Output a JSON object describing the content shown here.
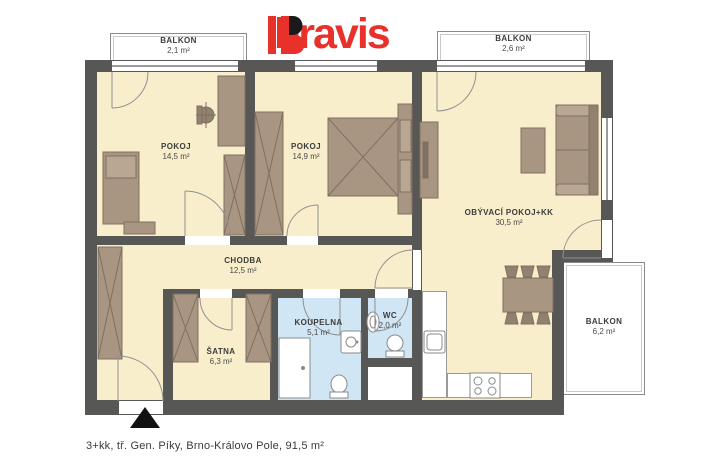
{
  "logo": {
    "brand": "bravis"
  },
  "caption": "3+kk, tř. Gen. Píky, Brno-Královo Pole, 91,5 m²",
  "rooms": {
    "balkon_tl": {
      "name": "BALKON",
      "area": "2,1 m²"
    },
    "balkon_tr": {
      "name": "BALKON",
      "area": "2,6 m²"
    },
    "balkon_right": {
      "name": "BALKON",
      "area": "6,2 m²"
    },
    "pokoj_1": {
      "name": "POKOJ",
      "area": "14,5 m²"
    },
    "pokoj_2": {
      "name": "POKOJ",
      "area": "14,9 m²"
    },
    "obyvaci": {
      "name": "OBÝVACÍ POKOJ+KK",
      "area": "30,5 m²"
    },
    "chodba": {
      "name": "CHODBA",
      "area": "12,5 m²"
    },
    "satna": {
      "name": "ŠATNA",
      "area": "6,3 m²"
    },
    "koupelna": {
      "name": "KOUPELNA",
      "area": "5,1 m²"
    },
    "wc": {
      "name": "WC",
      "area": "2,0 m²"
    }
  },
  "colors": {
    "wall": "#575756",
    "floor": "#f8eecb",
    "bath_floor": "#d0e6f4",
    "furniture": "#a89683",
    "logo_red": "#e8312a"
  }
}
